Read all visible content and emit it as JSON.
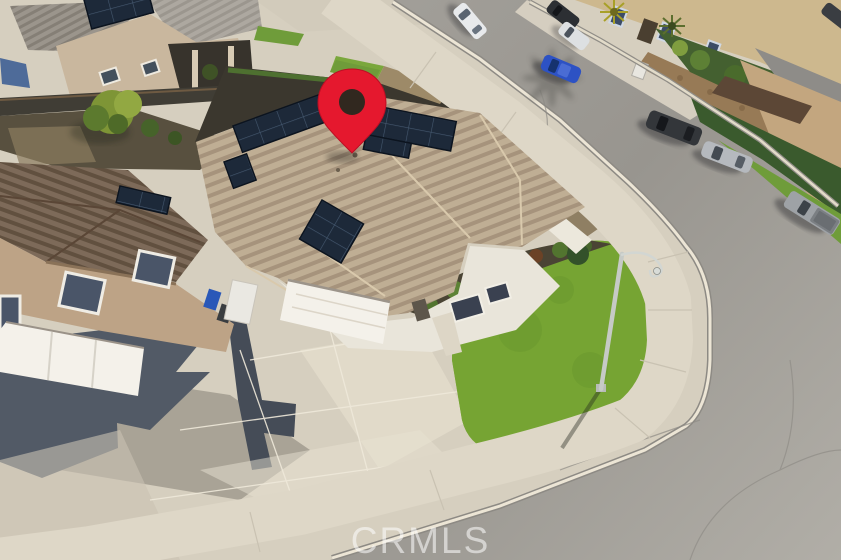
{
  "meta": {
    "image_type": "aerial real-estate drone photo",
    "subject": "single-story corner-lot home with rooftop solar panels marked by a red map pin"
  },
  "watermark": {
    "text": "CRMLS"
  },
  "pin": {
    "label": "property-location-pin",
    "color": "#e5182e",
    "stroke": "#bb0f24",
    "hole_color": "#31281f"
  },
  "colors": {
    "asphalt": "#a09d97",
    "sidewalk_concrete": "#ded7c7",
    "driveway_concrete": "#d9d2c2",
    "lawn_green": "#76a433",
    "parkway_grass": "#6f9c3a",
    "hedge_green": "#3a5a2d",
    "main_roof_tan": "#bfae94",
    "left_house_roof_brown": "#7d6a59",
    "gray_shingle": "#9b958c",
    "solar_panel_navy": "#1d2939",
    "stucco_white": "#e9e5da",
    "garage_door_white": "#f4f1ea",
    "left_house_wall_tan": "#bda386",
    "beige_house_wall": "#cdb88e",
    "stone_wall_tan": "#977a56",
    "rock_slope": "#8f7f63",
    "streetlight_gray": "#c6cac6"
  },
  "vehicles": [
    {
      "label": "white-sedan"
    },
    {
      "label": "dark-suv-top"
    },
    {
      "label": "white-suv"
    },
    {
      "label": "blue-sedan"
    },
    {
      "label": "dark-gray-suv"
    },
    {
      "label": "silver-sedan"
    },
    {
      "label": "gray-pickup-truck"
    },
    {
      "label": "dark-car-edge"
    }
  ],
  "landmarks": {
    "subject_house": "tan tile roof with four solar arrays and white garage",
    "corner_lawn": "bright green corner lawn",
    "streetlight": "streetlight pole over lawn",
    "left_house": "two-story tan house with white garage doors",
    "top_left_house": "two-story beige house with rooftop solar",
    "top_right_houses": "beige homes behind stone wall and hedge"
  }
}
